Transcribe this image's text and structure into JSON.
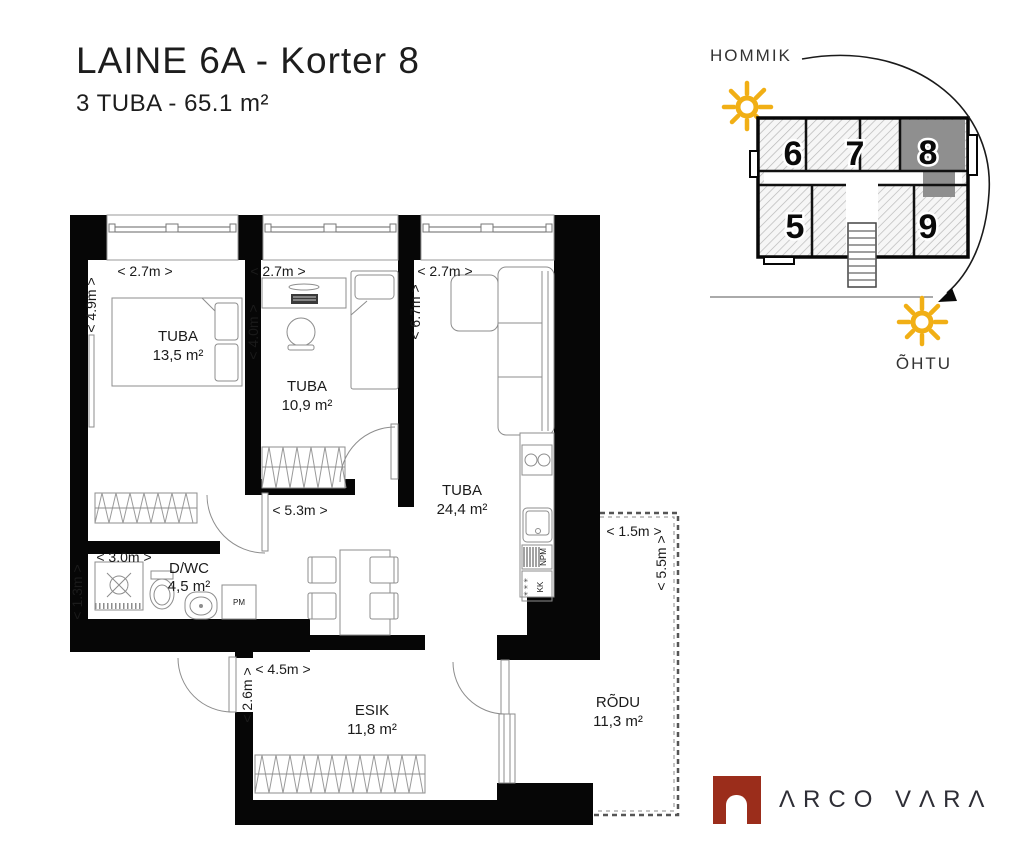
{
  "header": {
    "title": "LAINE 6A - Korter 8",
    "subtitle": "3 TUBA - 65.1 m²"
  },
  "plan": {
    "rooms": [
      {
        "name": "TUBA",
        "area": "13,5 m²"
      },
      {
        "name": "TUBA",
        "area": "10,9 m²"
      },
      {
        "name": "TUBA",
        "area": "24,4 m²"
      },
      {
        "name": "D/WC",
        "area": "4,5 m²"
      },
      {
        "name": "ESIK",
        "area": "11,8 m²"
      },
      {
        "name": "RÕDU",
        "area": "11,3 m²"
      }
    ],
    "dims": {
      "room1_w": "< 2.7m >",
      "room1_h": "< 4.9m >",
      "room2_w": "< 2.7m >",
      "room2_h": "< 4.0m >",
      "room3_w": "< 2.7m >",
      "room3_h": "< 6.7m >",
      "hall_w": "< 5.3m >",
      "dwc_w": "< 3.0m >",
      "dwc_h": "< 1.3m >",
      "esik_w": "< 4.5m >",
      "esik_h": "< 2.6m >",
      "rodu_w": "< 1.5m >",
      "rodu_h": "< 5.5m >"
    },
    "appliances": {
      "washing_machine": "PM",
      "dishwasher": "NPM",
      "fridge": "KK",
      "fridge_symbols": "✳ ✳ ✳"
    }
  },
  "site": {
    "morning_label": "HOMMIK",
    "evening_label": "ÕHTU",
    "units": [
      "6",
      "7",
      "8",
      "5",
      "9"
    ],
    "highlighted_unit": "8",
    "sun_color": "#F1AF15",
    "highlight_color": "#8F8F8F"
  },
  "footer": {
    "brand": "ΛRCO VΛRΛ",
    "brand_color": "#9B2D1B"
  }
}
